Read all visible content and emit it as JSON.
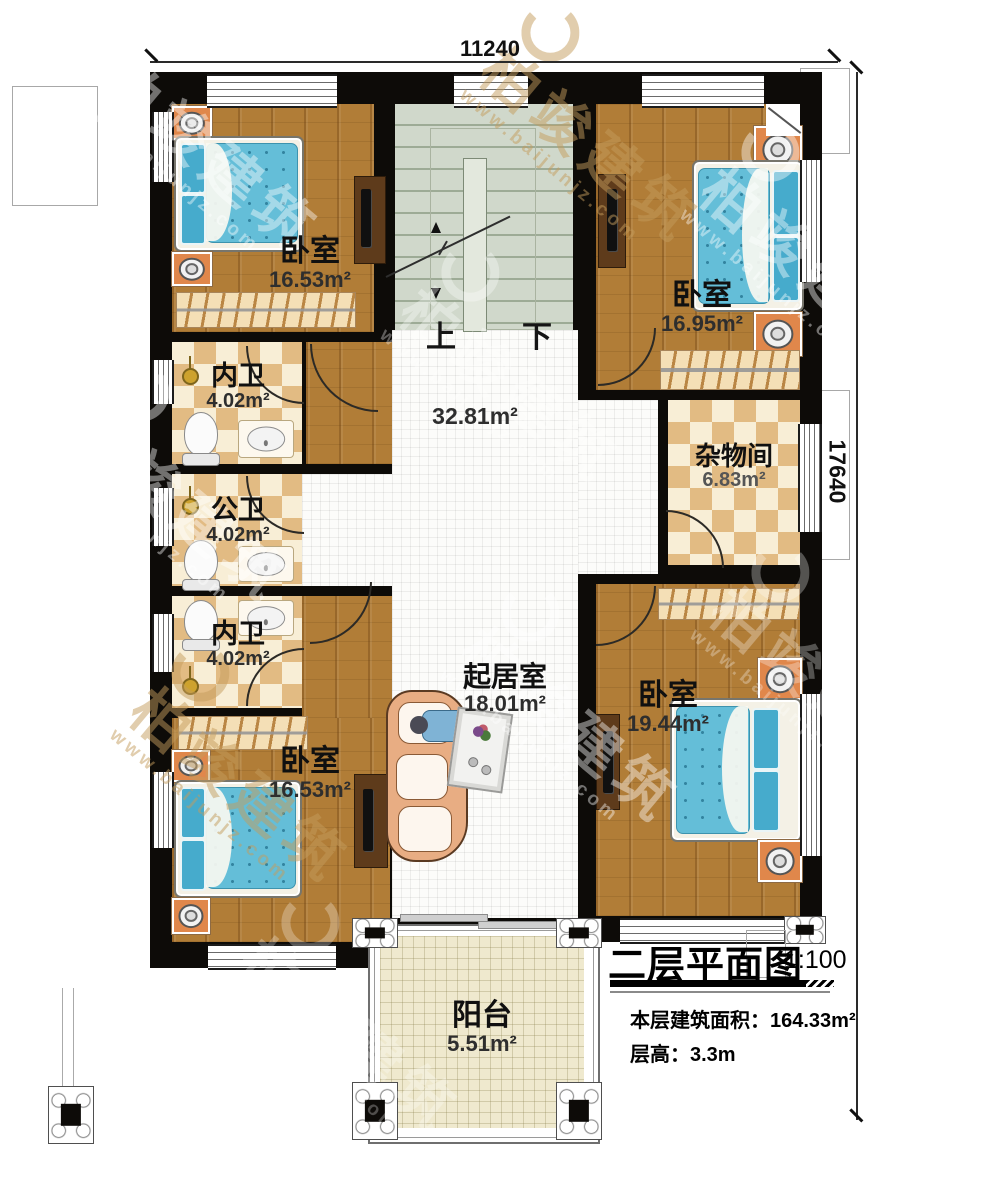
{
  "dims": {
    "width": "11240",
    "height": "17640"
  },
  "rooms": {
    "bedroom_tl": {
      "name": "卧室",
      "area": "16.53m²"
    },
    "bedroom_tr": {
      "name": "卧室",
      "area": "16.95m²"
    },
    "bath_top": {
      "name": "内卫",
      "area": "4.02m²"
    },
    "bath_mid": {
      "name": "公卫",
      "area": "4.02m²"
    },
    "bath_low": {
      "name": "内卫",
      "area": "4.02m²"
    },
    "storage": {
      "name": "杂物间",
      "area": "6.83m²"
    },
    "hall": {
      "area": "32.81m²"
    },
    "living": {
      "name": "起居室",
      "area": "18.01m²"
    },
    "bedroom_bl": {
      "name": "卧室",
      "area": "16.53m²"
    },
    "bedroom_br": {
      "name": "卧室",
      "area": "19.44m²"
    },
    "balcony": {
      "name": "阳台",
      "area": "5.51m²"
    }
  },
  "stairs": {
    "up": "上",
    "down": "下"
  },
  "title_block": {
    "title": "二层平面图",
    "scale": "1:100",
    "floor_area": "本层建筑面积：164.33m²",
    "floor_height": "层高：3.3m"
  },
  "watermark": {
    "brand": "柏竣建筑",
    "url": "www.baijunjz.com"
  }
}
